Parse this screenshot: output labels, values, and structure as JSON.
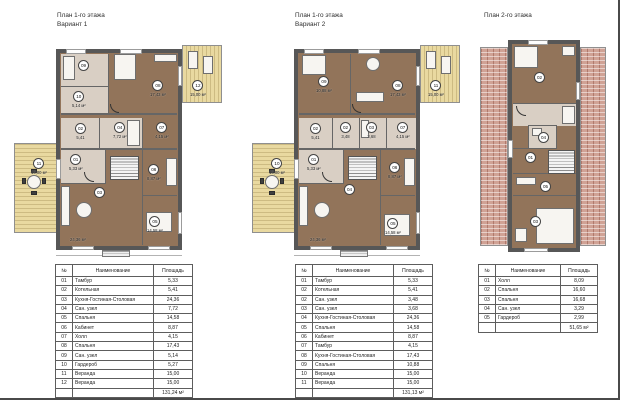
{
  "sheet": {
    "plans": [
      {
        "title": [
          "План 1-го этажа",
          "Вариант 1"
        ],
        "rooms": [
          {
            "num": "01",
            "area": "5,33 м²"
          },
          {
            "num": "02",
            "area": "5,41"
          },
          {
            "num": "03",
            "area": "24,36 м²"
          },
          {
            "num": "04",
            "area": "7,72 м²"
          },
          {
            "num": "05",
            "area": "14,58 м²"
          },
          {
            "num": "06",
            "area": "8,87 м²"
          },
          {
            "num": "07",
            "area": "4,15 м²"
          },
          {
            "num": "08",
            "area": "17,43 м²"
          },
          {
            "num": "09",
            "area": ""
          },
          {
            "num": "10",
            "area": "5,14 м²"
          },
          {
            "num": "11",
            "area": "15,00 м²"
          },
          {
            "num": "12",
            "area": "15,00 м²"
          }
        ]
      },
      {
        "title": [
          "План 1-го этажа",
          "Вариант 2"
        ],
        "rooms": [
          {
            "num": "01",
            "area": "5,33 м²"
          },
          {
            "num": "02",
            "area": "5,41"
          },
          {
            "num": "02",
            "area": "3,48"
          },
          {
            "num": "03",
            "area": "3,68"
          },
          {
            "num": "04",
            "area": "24,36 м²"
          },
          {
            "num": "05",
            "area": "14,58 м²"
          },
          {
            "num": "06",
            "area": "8,87 м²"
          },
          {
            "num": "07",
            "area": "4,15 м²"
          },
          {
            "num": "08",
            "area": "17,43 м²"
          },
          {
            "num": "09",
            "area": "10,88 м²"
          },
          {
            "num": "10",
            "area": "15,00 м²"
          },
          {
            "num": "11",
            "area": "15,00 м²"
          }
        ]
      },
      {
        "title": [
          "План 2-го этажа",
          ""
        ],
        "rooms": [
          {
            "num": "01",
            "area": ""
          },
          {
            "num": "02",
            "area": ""
          },
          {
            "num": "03",
            "area": ""
          },
          {
            "num": "04",
            "area": ""
          },
          {
            "num": "05",
            "area": ""
          }
        ]
      }
    ],
    "tables": [
      {
        "headers": [
          "№",
          "Наименование",
          "Площадь"
        ],
        "rows": [
          {
            "n": "01",
            "name": "Тамбур",
            "a": "5,33"
          },
          {
            "n": "02",
            "name": "Котельная",
            "a": "5,41"
          },
          {
            "n": "03",
            "name": "Кухня-Гостиная-Столовая",
            "a": "24,36"
          },
          {
            "n": "04",
            "name": "Сан. узел",
            "a": "7,72"
          },
          {
            "n": "05",
            "name": "Спальня",
            "a": "14,58"
          },
          {
            "n": "06",
            "name": "Кабинет",
            "a": "8,87"
          },
          {
            "n": "07",
            "name": "Холл",
            "a": "4,15"
          },
          {
            "n": "08",
            "name": "Спальня",
            "a": "17,43"
          },
          {
            "n": "09",
            "name": "Сан. узел",
            "a": "5,14"
          },
          {
            "n": "10",
            "name": "Гардероб",
            "a": "5,27"
          },
          {
            "n": "11",
            "name": "Веранда",
            "a": "15,00"
          },
          {
            "n": "12",
            "name": "Веранда",
            "a": "15,00"
          }
        ],
        "total": "131,24 м²"
      },
      {
        "headers": [
          "№",
          "Наименование",
          "Площадь"
        ],
        "rows": [
          {
            "n": "01",
            "name": "Тамбур",
            "a": "5,33"
          },
          {
            "n": "02",
            "name": "Котельная",
            "a": "5,41"
          },
          {
            "n": "02",
            "name": "Сан. узел",
            "a": "3,48"
          },
          {
            "n": "03",
            "name": "Сан. узел",
            "a": "3,68"
          },
          {
            "n": "04",
            "name": "Кухня-Гостиная-Столовая",
            "a": "24,36"
          },
          {
            "n": "05",
            "name": "Спальня",
            "a": "14,58"
          },
          {
            "n": "06",
            "name": "Кабинет",
            "a": "8,87"
          },
          {
            "n": "07",
            "name": "Тамбур",
            "a": "4,15"
          },
          {
            "n": "08",
            "name": "Кухня-Гостиная-Столовая",
            "a": "17,43"
          },
          {
            "n": "09",
            "name": "Спальня",
            "a": "10,88"
          },
          {
            "n": "10",
            "name": "Веранда",
            "a": "15,00"
          },
          {
            "n": "11",
            "name": "Веранда",
            "a": "15,00"
          }
        ],
        "total": "131,13 м²"
      },
      {
        "headers": [
          "№",
          "Наименование",
          "Площадь"
        ],
        "rows": [
          {
            "n": "01",
            "name": "Холл",
            "a": "8,09"
          },
          {
            "n": "02",
            "name": "Спальня",
            "a": "16,60"
          },
          {
            "n": "03",
            "name": "Спальня",
            "a": "16,68"
          },
          {
            "n": "04",
            "name": "Сан. узел",
            "a": "3,29"
          },
          {
            "n": "05",
            "name": "Гардероб",
            "a": "2,99"
          }
        ],
        "total": "51,65 м²"
      }
    ]
  }
}
